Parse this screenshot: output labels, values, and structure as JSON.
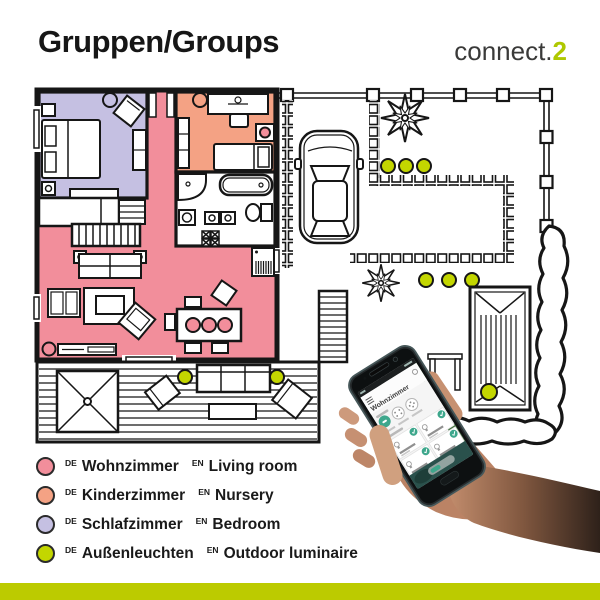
{
  "header": {
    "title": "Gruppen/Groups",
    "logo": {
      "brand": "connect.",
      "accent": "2"
    }
  },
  "legend": [
    {
      "marker_color": "#F28E9B",
      "de_tag": "DE",
      "de": "Wohnzimmer",
      "en_tag": "EN",
      "en": "Living room"
    },
    {
      "marker_color": "#F4A284",
      "de_tag": "DE",
      "de": "Kinderzimmer",
      "en_tag": "EN",
      "en": "Nursery"
    },
    {
      "marker_color": "#C5C0E2",
      "de_tag": "DE",
      "de": "Schlafzimmer",
      "en_tag": "EN",
      "en": "Bedroom"
    },
    {
      "marker_color": "#C3D600",
      "de_tag": "DE",
      "de": "Außenleuchten",
      "en_tag": "EN",
      "en": "Outdoor luminaire"
    }
  ],
  "floor_plan": {
    "rooms": [
      {
        "name": "Wohnzimmer / Living room",
        "color": "#F28E9B"
      },
      {
        "name": "Kinderzimmer / Nursery",
        "color": "#F4A284"
      },
      {
        "name": "Schlafzimmer / Bedroom",
        "color": "#C5C0E2"
      }
    ],
    "outdoor_luminaire_color": "#C3D600",
    "outdoor_luminaire_count": 9
  },
  "phone": {
    "screen_title": "Wohnzimmer"
  },
  "footer": {
    "bar_color": "#BCCB00"
  }
}
